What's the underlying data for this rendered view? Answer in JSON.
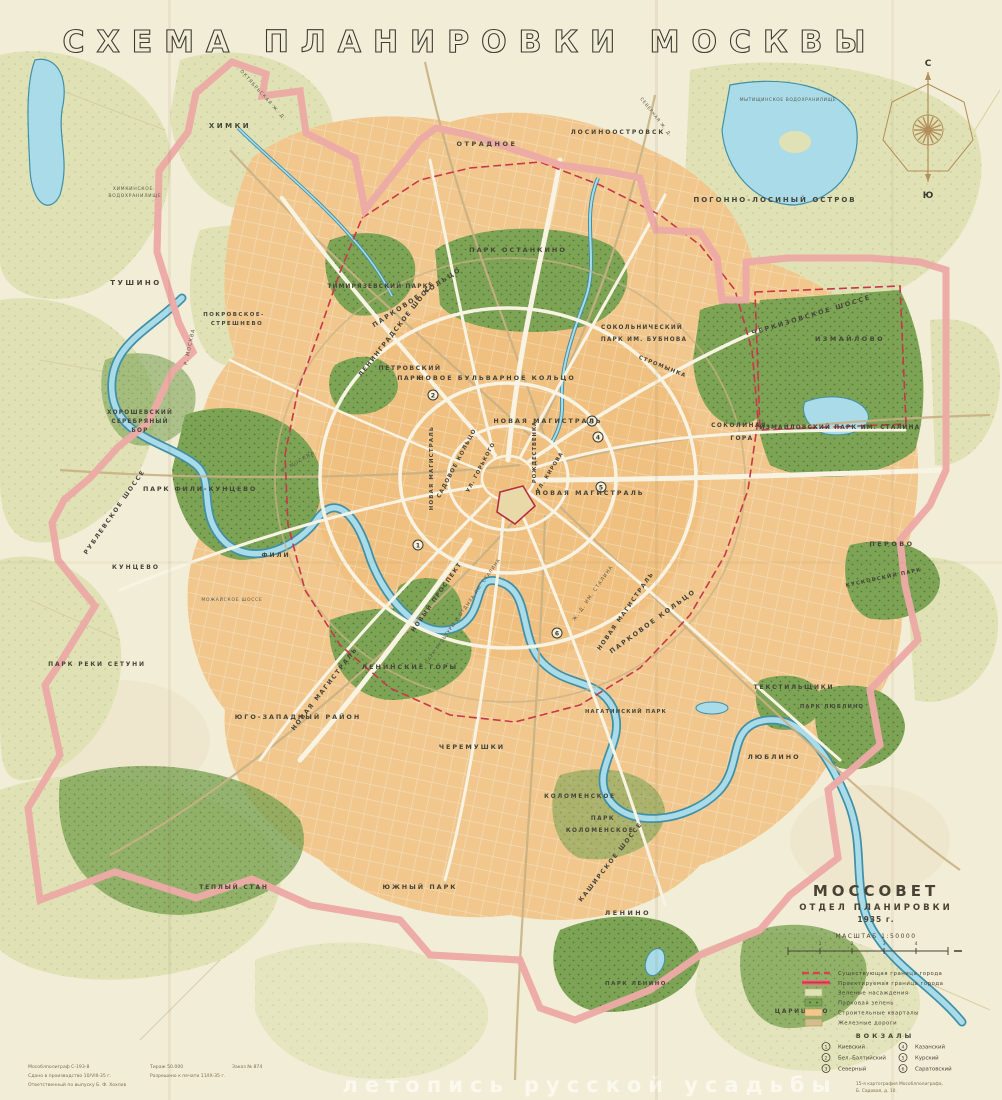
{
  "title": "СХЕМА  ПЛАНИРОВКИ  МОСКВЫ",
  "compass": {
    "north": "С",
    "south": "Ю"
  },
  "publisher": {
    "org": "МОССОВЕТ",
    "dept": "ОТДЕЛ ПЛАНИРОВКИ",
    "year": "1935 г.",
    "scale": "МАСШТАБ 1:50000",
    "scale_ticks": [
      "1",
      "2",
      "3",
      "4"
    ]
  },
  "legend": {
    "items": [
      {
        "swatch": "dashed-red-line",
        "label": "Существующая граница города"
      },
      {
        "swatch": "solid-red-band",
        "label": "Проектируемая граница города"
      },
      {
        "swatch": "pale-green-box",
        "label": "Зеленые насаждения"
      },
      {
        "swatch": "park-green-box",
        "label": "Парковая зелень"
      },
      {
        "swatch": "orange-box",
        "label": "Строительные кварталы"
      },
      {
        "swatch": "tan-box",
        "label": "Железные дороги"
      }
    ],
    "vokzaly_title": "ВОКЗАЛЫ",
    "stations": [
      {
        "num": "1",
        "name": "Киевский"
      },
      {
        "num": "2",
        "name": "Бел.-Балтийский"
      },
      {
        "num": "3",
        "name": "Северный"
      },
      {
        "num": "4",
        "name": "Казанский"
      },
      {
        "num": "5",
        "name": "Курский"
      },
      {
        "num": "6",
        "name": "Саратовский"
      }
    ]
  },
  "map_markers": [
    "1",
    "2",
    "3",
    "4",
    "5",
    "6"
  ],
  "imprint": {
    "line1a": "Мособлполиграф С-193-8",
    "line1b": "Тираж 50.000",
    "line1c": "Заказ № 874",
    "line2a": "Сдано в производство 10/VIII-35 г.",
    "line2b": "Разрешено к печати 11/IX-35 г.",
    "line3": "Ответственный по выпуску Б. Ф. Хохлов",
    "right1": "15-я картография Мособлполиграфа,",
    "right2": "Б. Садовая, д. 10."
  },
  "watermark": "летопись русской усадьбы",
  "labels": {
    "khimki": "ХИМКИ",
    "oktyabrskaya": "ОКТЯБРЬСКАЯ Ж. Д.",
    "tushino": "ТУШИНО",
    "pokrovskoe1": "ПОКРОВСКОЕ-",
    "pokrovskoe2": "СТРЕШНЕВО",
    "khimki_res1": "ХИМКИНСКОЕ",
    "khimki_res2": "ВОДОХРАНИЛИЩЕ",
    "otradnoe": "ОТРАДНОЕ",
    "losinoostrovsk": "ЛОСИНООСТРОВСК",
    "severnaya_zhd": "СЕВЕРНАЯ Ж. Д.",
    "mytishchi_res": "МЫТИЩИНСКОЕ ВОДОХРАНИЛИЩЕ",
    "pogonno": "ПОГОННО-ЛОСИНЫЙ ОСТРОВ",
    "khoroshevsky1": "ХОРОШЕВСКИЙ",
    "khoroshevsky2": "СЕРЕБРЯНЫЙ",
    "khoroshevsky3": "БОР",
    "leningradskoe": "ЛЕНИНГРАДСКОЕ ШОССЕ",
    "petrovsky1": "ПЕТРОВСКИЙ",
    "petrovsky2": "ПАРК",
    "timiryazevsky": "ТИМИРЯЗЕВСКИЙ ПАРК",
    "ostankino": "ПАРК ОСТАНКИНО",
    "sokolniki1": "СОКОЛЬНИЧЕСКИЙ",
    "sokolniki2": "ПАРК ИМ. БУБНОВА",
    "cherkizovskoe": "ЧЕРКИЗОВСКОЕ  ШОССЕ",
    "izmailovo": "ИЗМАЙЛОВО",
    "izmailovsky": "ИЗМАЙЛОВСКИЙ ПАРК ИМ. СТАЛИНА",
    "sokolinaya1": "СОКОЛИНАЯ",
    "sokolinaya2": "ГОРА",
    "stromynka": "СТРОМЫНКА",
    "novoe_bulvarnoe": "НОВОЕ   БУЛЬВАРНОЕ   КОЛЬЦО",
    "parkovoe_nw": "ПАРКОВОЕ  КОЛЬЦО",
    "parkovoe_se": "ПАРКОВОЕ  КОЛЬЦО",
    "sadovoe": "САДОВОЕ  КОЛЬЦО",
    "gorkogo": "УЛ. ГОРЬКОГО",
    "rozhdestvenka": "РОЖДЕСТВЕНКА",
    "kirova": "УЛ. КИРОВА",
    "nm_north": "НОВАЯ  МАГИСТРАЛЬ",
    "nm_mid": "НОВАЯ  МАГИСТРАЛЬ",
    "nm_west": "НОВАЯ МАГИСТРАЛЬ",
    "nm_sw": "НОВАЯ  МАГИСТРАЛЬ",
    "nm_se": "НОВАЯ МАГИСТРАЛЬ",
    "zhd_stalina": "Ж.-Д. ИМ. СТАЛИНА",
    "novy_prospekt": "НОВЫЙ  ПРОСПЕКТ",
    "park_kultury": "ПАРК КУЛЬТУРЫ И ОТДЫХА ИМ. СТАЛИНА",
    "leninskie": "ЛЕНИНСКИЕ  ГОРЫ",
    "yugozap": "ЮГО-ЗАПАДНЫЙ  РАЙОН",
    "cheremushki": "ЧЕРЕМУШКИ",
    "kolomenskoe": "КОЛОМЕНСКОЕ",
    "park_kol1": "ПАРК",
    "park_kol2": "КОЛОМЕНСКОЕ",
    "kashirskoe": "КАШИРСКОЕ  ШОССЕ",
    "nagatinsky": "НАГАТИНСКИЙ ПАРК",
    "yuzhny": "ЮЖНЫЙ  ПАРК",
    "tepliy": "ТЕПЛЫЙ СТАН",
    "lenino": "ЛЕНИНО",
    "park_lenino": "ПАРК ЛЕНИНО",
    "tsaritsyno": "ЦАРИЦЫНО",
    "park_setuni": "ПАРК  РЕКИ  СЕТУНИ",
    "kuntsevo": "КУНЦЕВО",
    "fili": "ФИЛИ",
    "park_fili": "ПАРК ФИЛИ-КУНЦЕВО",
    "rublevskoe": "РУБЛЕВСКОЕ  ШОССЕ",
    "mozhayskoe": "МОЖАЙСКОЕ ШОССЕ",
    "tekstil": "ТЕКСТИЛЬЩИКИ",
    "lyublino": "ЛЮБЛИНО",
    "park_lyublino": "ПАРК ЛЮБЛИНО",
    "perovo": "ПЕРОВО",
    "kuskovsky": "КУСКОВСКИЙ ПАРК",
    "r_moskva1": "Р. МОСКВА",
    "r_moskva2": "Р. МОСКВА"
  },
  "colors": {
    "paper": "#f2edd6",
    "urban": "#f1c78d",
    "park_green": "#79a251",
    "pale_green": "#e2e4ba",
    "water": "#a9dce8",
    "water_line": "#4090a8",
    "boundary_red": "#c24553",
    "rail_tan": "#c9b184",
    "label_ink": "#45443a"
  }
}
